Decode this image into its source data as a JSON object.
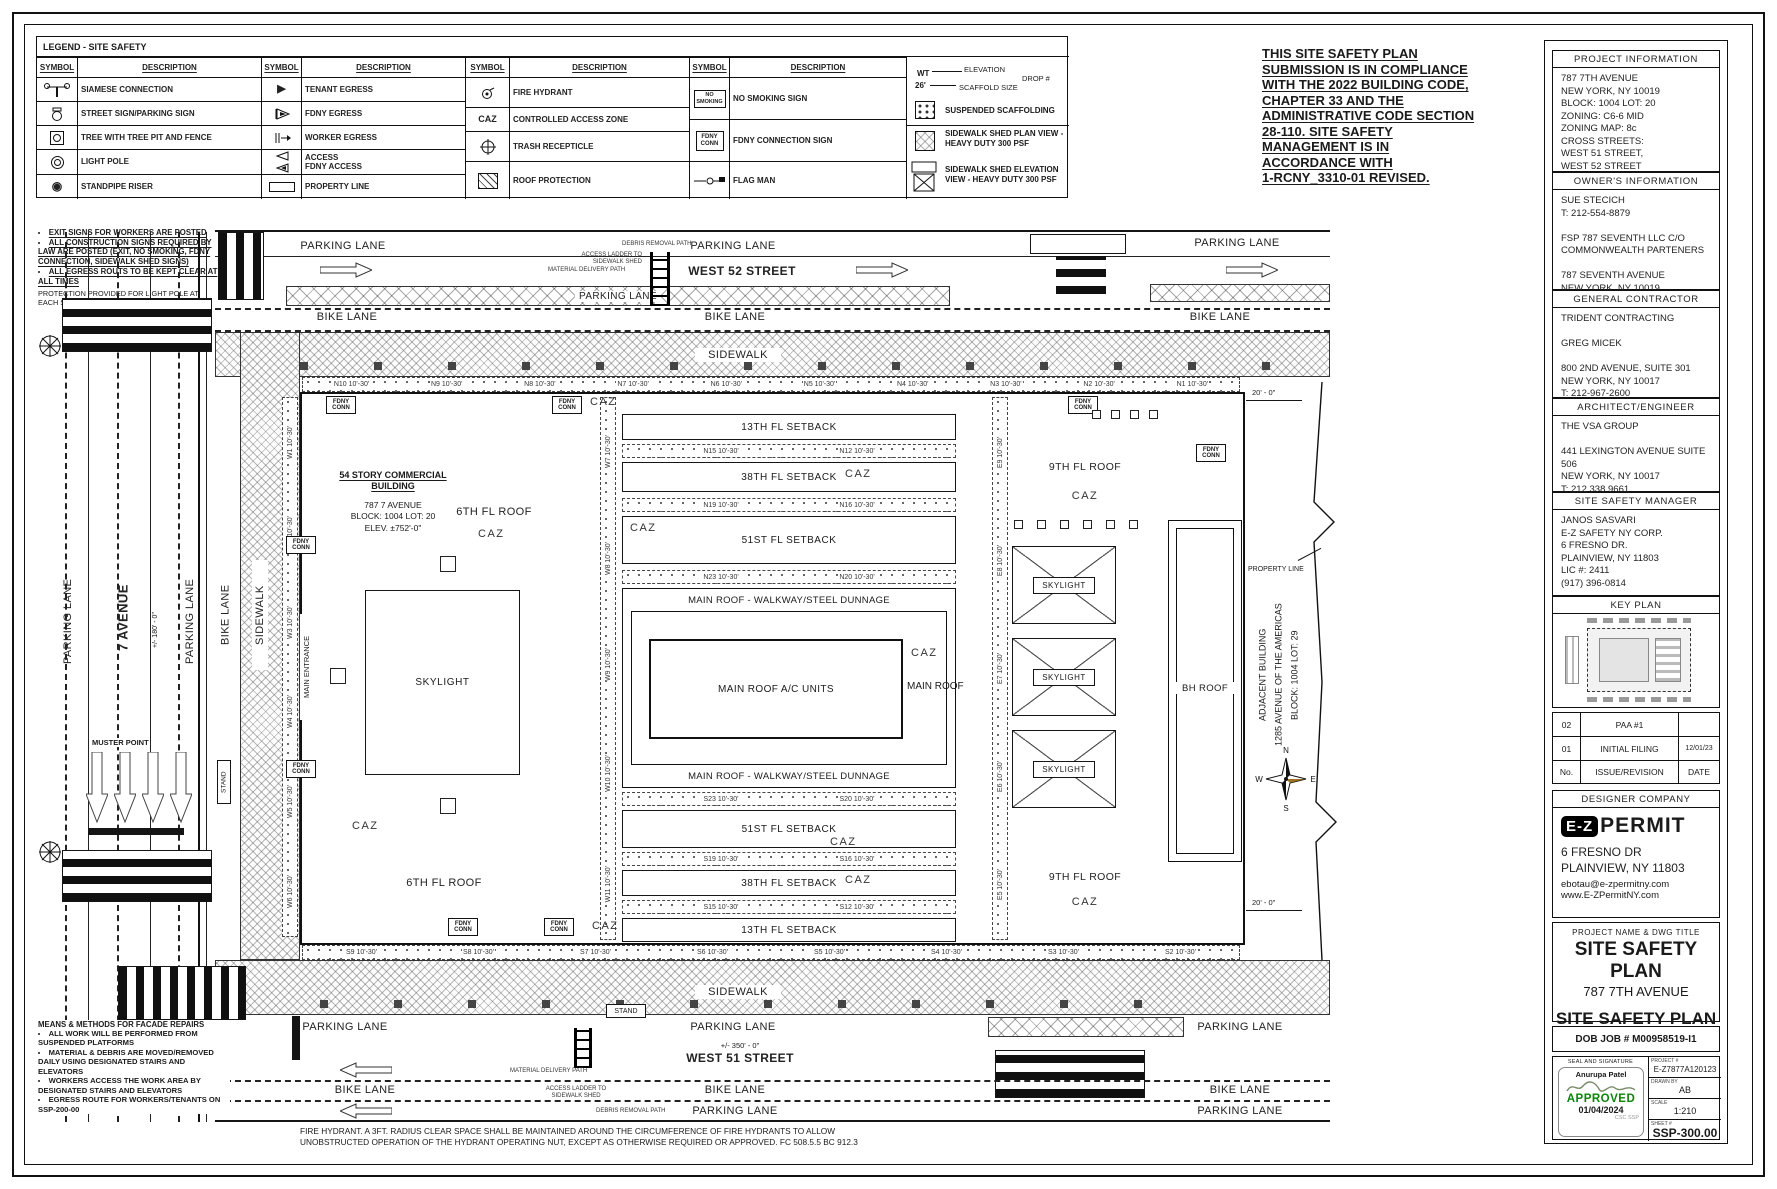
{
  "legend": {
    "title": "LEGEND - SITE SAFETY",
    "h_symbol": "SYMBOL",
    "h_desc": "DESCRIPTION",
    "g1": [
      "SIAMESE CONNECTION",
      "STREET SIGN/PARKING SIGN",
      "TREE WITH TREE PIT AND FENCE",
      "LIGHT POLE",
      "STANDPIPE RISER"
    ],
    "g2": [
      "TENANT EGRESS",
      "FDNY EGRESS",
      "WORKER EGRESS",
      [
        "ACCESS",
        "FDNY ACCESS"
      ],
      "PROPERTY LINE"
    ],
    "g3": [
      "FIRE HYDRANT",
      "CONTROLLED ACCESS ZONE",
      "TRASH RECEPTICLE",
      "ROOF PROTECTION"
    ],
    "g3_caz": "CAZ",
    "g4": [
      "NO SMOKING SIGN",
      "FDNY CONNECTION SIGN",
      "FLAG MAN"
    ],
    "sym_no_smoking": "NO SMOKING",
    "sym_fdny_conn": "FDNY CONN",
    "g5": {
      "wt": "WT",
      "size": "26'",
      "elevation": "ELEVATION",
      "drop": "DROP #",
      "scaffold_size": "SCAFFOLD SIZE",
      "suspended": "SUSPENDED SCAFFOLDING",
      "shed_plan": "SIDEWALK SHED PLAN VIEW - HEAVY DUTY 300 PSF",
      "shed_elev": "SIDEWALK SHED ELEVATION VIEW - HEAVY DUTY 300 PSF"
    }
  },
  "compliance": [
    "THIS SITE SAFETY PLAN",
    "SUBMISSION IS IN COMPLIANCE",
    "WITH THE 2022 BUILDING CODE,",
    "CHAPTER 33 AND THE",
    "ADMINISTRATIVE CODE SECTION",
    "28-110. SITE SAFETY",
    "MANAGEMENT IS IN",
    "ACCORDANCE WITH",
    "1-RCNY_3310-01 REVISED."
  ],
  "notes_top": {
    "items": [
      "EXIT SIGNS FOR WORKERS ARE POSTED",
      "ALL CONSTRUCTION SIGNS REQUIRED BY LAW ARE POSTED (EXIT, NO SMOKING, FDNY CONNECTION, SIDEWALK SHED SIGNS)",
      "ALL EGRESS ROUTS TO BE KEPT CLEAR AT ALL TIMES"
    ],
    "protection": "PROTECTION PROVIDED FOR LIGHT POLE AT EACH STREET LINE BC 3309.11"
  },
  "notes_bottom": {
    "title": "MEANS & METHODS FOR FACADE REPAIRS",
    "items": [
      "ALL WORK WILL BE PERFORMED FROM SUSPENDED PLATFORMS",
      "MATERIAL & DEBRIS ARE MOVED/REMOVED DAILY USING DESIGNATED STAIRS AND ELEVATORS",
      "WORKERS ACCESS THE WORK AREA BY DESIGNATED STAIRS AND ELEVATORS",
      "EGRESS ROUTE FOR WORKERS/TENANTS ON SSP-200-00"
    ]
  },
  "hydrant_note": [
    "FIRE HYDRANT. A 3FT. RADIUS CLEAR SPACE SHALL BE MAINTAINED AROUND THE CIRCUMFERENCE OF FIRE HYDRANTS TO ALLOW",
    "UNOBSTRUCTED OPERATION OF THE HYDRANT OPERATING NUT, EXCEPT AS OTHERWISE REQUIRED OR APPROVED. FC 508.5.5 BC 912.3"
  ],
  "plan": {
    "streets": {
      "west52": "WEST 52 STREET",
      "west51": "WEST 51 STREET",
      "ave7": "7 AVENUE",
      "parking": "PARKING LANE",
      "bike": "BIKE LANE",
      "sidewalk": "SIDEWALK",
      "dim_350": "+/- 350' - 0\"",
      "dim_180": "+/- 180' - 0\"",
      "dim_20": "20' - 0\""
    },
    "building": {
      "name": [
        "54 STORY COMMERCIAL",
        "BUILDING"
      ],
      "info": [
        "787 7 AVENUE",
        "BLOCK: 1004 LOT: 20",
        "ELEV. ±752'-0\""
      ]
    },
    "adjacent": [
      "ADJACENT BUILDING",
      "1285 AVENUE OF THE AMERICAS",
      "BLOCK: 1004 LOT: 29"
    ],
    "labels": {
      "roof6": "6TH FL ROOF",
      "roof9": "9TH FL ROOF",
      "caz": "CAZ",
      "skylight": "SKYLIGHT",
      "bh_roof": "BH ROOF",
      "setback13": "13TH FL SETBACK",
      "setback38": "38TH FL SETBACK",
      "setback51": "51ST FL SETBACK",
      "main_walk": "MAIN ROOF - WALKWAY/STEEL DUNNAGE",
      "main_ac": "MAIN ROOF A/C UNITS",
      "main_roof": "MAIN ROOF",
      "property_line": "PROPERTY LINE",
      "muster": "MUSTER POINT",
      "main_entrance": "MAIN ENTRANCE",
      "stand": "STAND",
      "fdny_conn": "FDNY CONN",
      "material_path": "MATERIAL DELIVERY PATH",
      "access_ladder": "ACCESS LADDER TO SIDEWALK SHED",
      "debris_path": "DEBRIS REMOVAL PATH"
    },
    "compass": {
      "n": "N",
      "e": "E",
      "s": "S",
      "w": "W"
    },
    "drops": {
      "north": [
        "N10 10'-30'",
        "N9 10'-30'",
        "N8 10'-30'",
        "N7 10'-30'",
        "N6 10'-30'",
        "N5 10'-30'",
        "N4 10'-30'",
        "N3 10'-30'",
        "N2 10'-30'",
        "N1 10'-30'"
      ],
      "south": [
        "S9 10'-30'",
        "S8 10'-30'",
        "S7 10'-30'",
        "S6 10'-30'",
        "S5 10'-30'",
        "S4 10'-30'",
        "S3 10'-30'",
        "S2 10'-30'"
      ],
      "west_outer": [
        "W1 10'-30'",
        "W2 10'-30'",
        "W3 10'-30'",
        "W4 10'-30'",
        "W5 10'-30'",
        "W6 10'-30'"
      ],
      "west_inner": [
        "W7 10'-30'",
        "W8 10'-30'",
        "W9 10'-30'",
        "W10 10'-30'",
        "W11 10'-30'"
      ],
      "east_inner": [
        "E9 10'-30'",
        "E8 10'-30'",
        "E7 10'-30'",
        "E6 10'-30'",
        "E5 10'-30'"
      ],
      "stripA": [
        "N15 10'-30'",
        "N12 10'-30'"
      ],
      "stripB": [
        "N19 10'-30'",
        "N16 10'-30'"
      ],
      "stripC": [
        "N23 10'-30'",
        "N20 10'-30'"
      ],
      "stripD": [
        "S23 10'-30'",
        "S20 10'-30'"
      ],
      "stripE": [
        "S19 10'-30'",
        "S16 10'-30'"
      ],
      "stripF": [
        "S15 10'-30'",
        "S12 10'-30'"
      ]
    }
  },
  "sidebar": {
    "project_info": {
      "title": "PROJECT INFORMATION",
      "lines": [
        "787 7TH AVENUE",
        "NEW YORK, NY 10019",
        "BLOCK: 1004 LOT: 20",
        "ZONING: C6-6 MID",
        "ZONING MAP: 8c",
        "CROSS STREETS:",
        "WEST 51 STREET,",
        "WEST 52 STREET"
      ]
    },
    "owner": {
      "title": "OWNER'S INFORMATION",
      "lines": [
        "SUE STECICH",
        "T: 212-554-8879",
        "",
        "FSP 787 SEVENTH LLC C/O",
        "COMMONWEALTH PARTENERS",
        "",
        "787 SEVENTH AVENUE",
        "NEW YORK, NY 10019"
      ]
    },
    "gc": {
      "title": "GENERAL CONTRACTOR",
      "lines": [
        "TRIDENT CONTRACTING",
        "",
        "GREG MICEK",
        "",
        "800 2ND AVENUE, SUITE 301",
        "NEW YORK, NY 10017",
        "T: 212-967-2600"
      ]
    },
    "ae": {
      "title": "ARCHITECT/ENGINEER",
      "lines": [
        "THE VSA GROUP",
        "",
        "441 LEXINGTON AVENUE SUITE 506",
        "NEW YORK, NY 10017",
        "T: 212 338 9661"
      ]
    },
    "ssm": {
      "title": "SITE SAFETY MANAGER",
      "lines": [
        "JANOS SASVARI",
        "E-Z SAFETY NY CORP.",
        "6 FRESNO DR.",
        "PLAINVIEW, NY 11803",
        "LIC #: 2411",
        "(917) 396-0814"
      ]
    },
    "key_plan_title": "KEY PLAN",
    "revisions": {
      "rows": [
        [
          "02",
          "PAA #1",
          ""
        ],
        [
          "01",
          "INITIAL FILING",
          "12/01/23"
        ],
        [
          "No.",
          "ISSUE/REVISION",
          "DATE"
        ]
      ]
    },
    "designer": {
      "title": "DESIGNER COMPANY",
      "logo_ez": "E-Z",
      "logo_permit": "PERMIT",
      "lines": [
        "6 FRESNO DR",
        "PLAINVIEW, NY 11803"
      ],
      "email": "ebotau@e-zpermitny.com",
      "web": "www.E-ZPermitNY.com"
    },
    "title_block": {
      "header": "PROJECT NAME & DWG TITLE",
      "title1": "SITE SAFETY PLAN",
      "subtitle": "787 7TH AVENUE",
      "title2": "SITE SAFETY PLAN"
    },
    "dob": "DOB JOB # M00958519-I1",
    "seal": {
      "label": "SEAL AND SIGNATURE",
      "name": "Anurupa Patel",
      "approved": "APPROVED",
      "date": "01/04/2024",
      "csc": "CSC SSP"
    },
    "fields": {
      "project_label": "PROJECT #",
      "project": "E-Z7877A120123",
      "drawn_label": "DRAWN BY",
      "drawn": "AB",
      "scale_label": "SCALE",
      "scale": "1:210",
      "sheet_label": "SHEET #",
      "sheet": "SSP-300.00"
    }
  }
}
